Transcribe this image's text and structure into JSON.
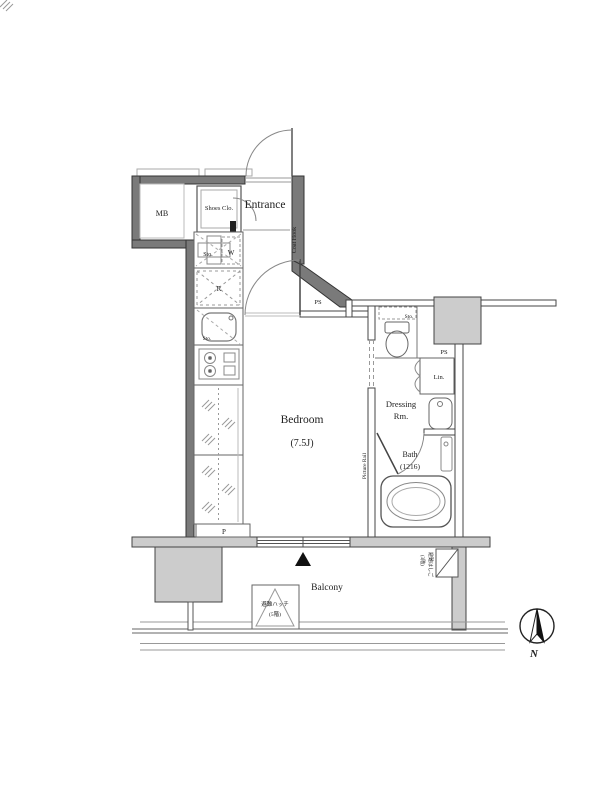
{
  "plan_type": "japanese-apartment-floor-plan",
  "labels": {
    "mb": "MB",
    "shoes_clo": "Shoes Clo.",
    "entrance": "Entrance",
    "coat_hook": "Coat Hook",
    "sto_hall": "Sto.",
    "washer": "W",
    "fridge": "R",
    "ps_upper": "PS",
    "sto_kitchen": "Sto.",
    "bedroom": "Bedroom",
    "bedroom_size": "(7.5J)",
    "sto_toilet": "Sto.",
    "ps_east": "PS",
    "linen": "Lin.",
    "dressing_1": "Dressing",
    "dressing_2": "Rm.",
    "bath": "Bath",
    "bath_size": "(1216)",
    "picture_rail": "Picture Rail",
    "pipe": "P",
    "balcony": "Balcony",
    "hatch_1": "避難ハッチ",
    "hatch_2": "(5階)",
    "ladder_1": "避難はしご",
    "ladder_2": "(3階)",
    "north": "N"
  },
  "colors": {
    "background": "#ffffff",
    "wall_fill": "#7a7a7a",
    "wall_stroke": "#333333",
    "column_fill": "#cccccc",
    "thin_line": "#555555",
    "fixture_line": "#888888",
    "text": "#222222",
    "marker": "#111111"
  },
  "icons": {
    "compass": "north-arrow-in-circle",
    "balcony_marker": "filled-triangle-up",
    "evac_hatch": "triangle-in-box",
    "evac_ladder": "diagonal-in-box"
  }
}
